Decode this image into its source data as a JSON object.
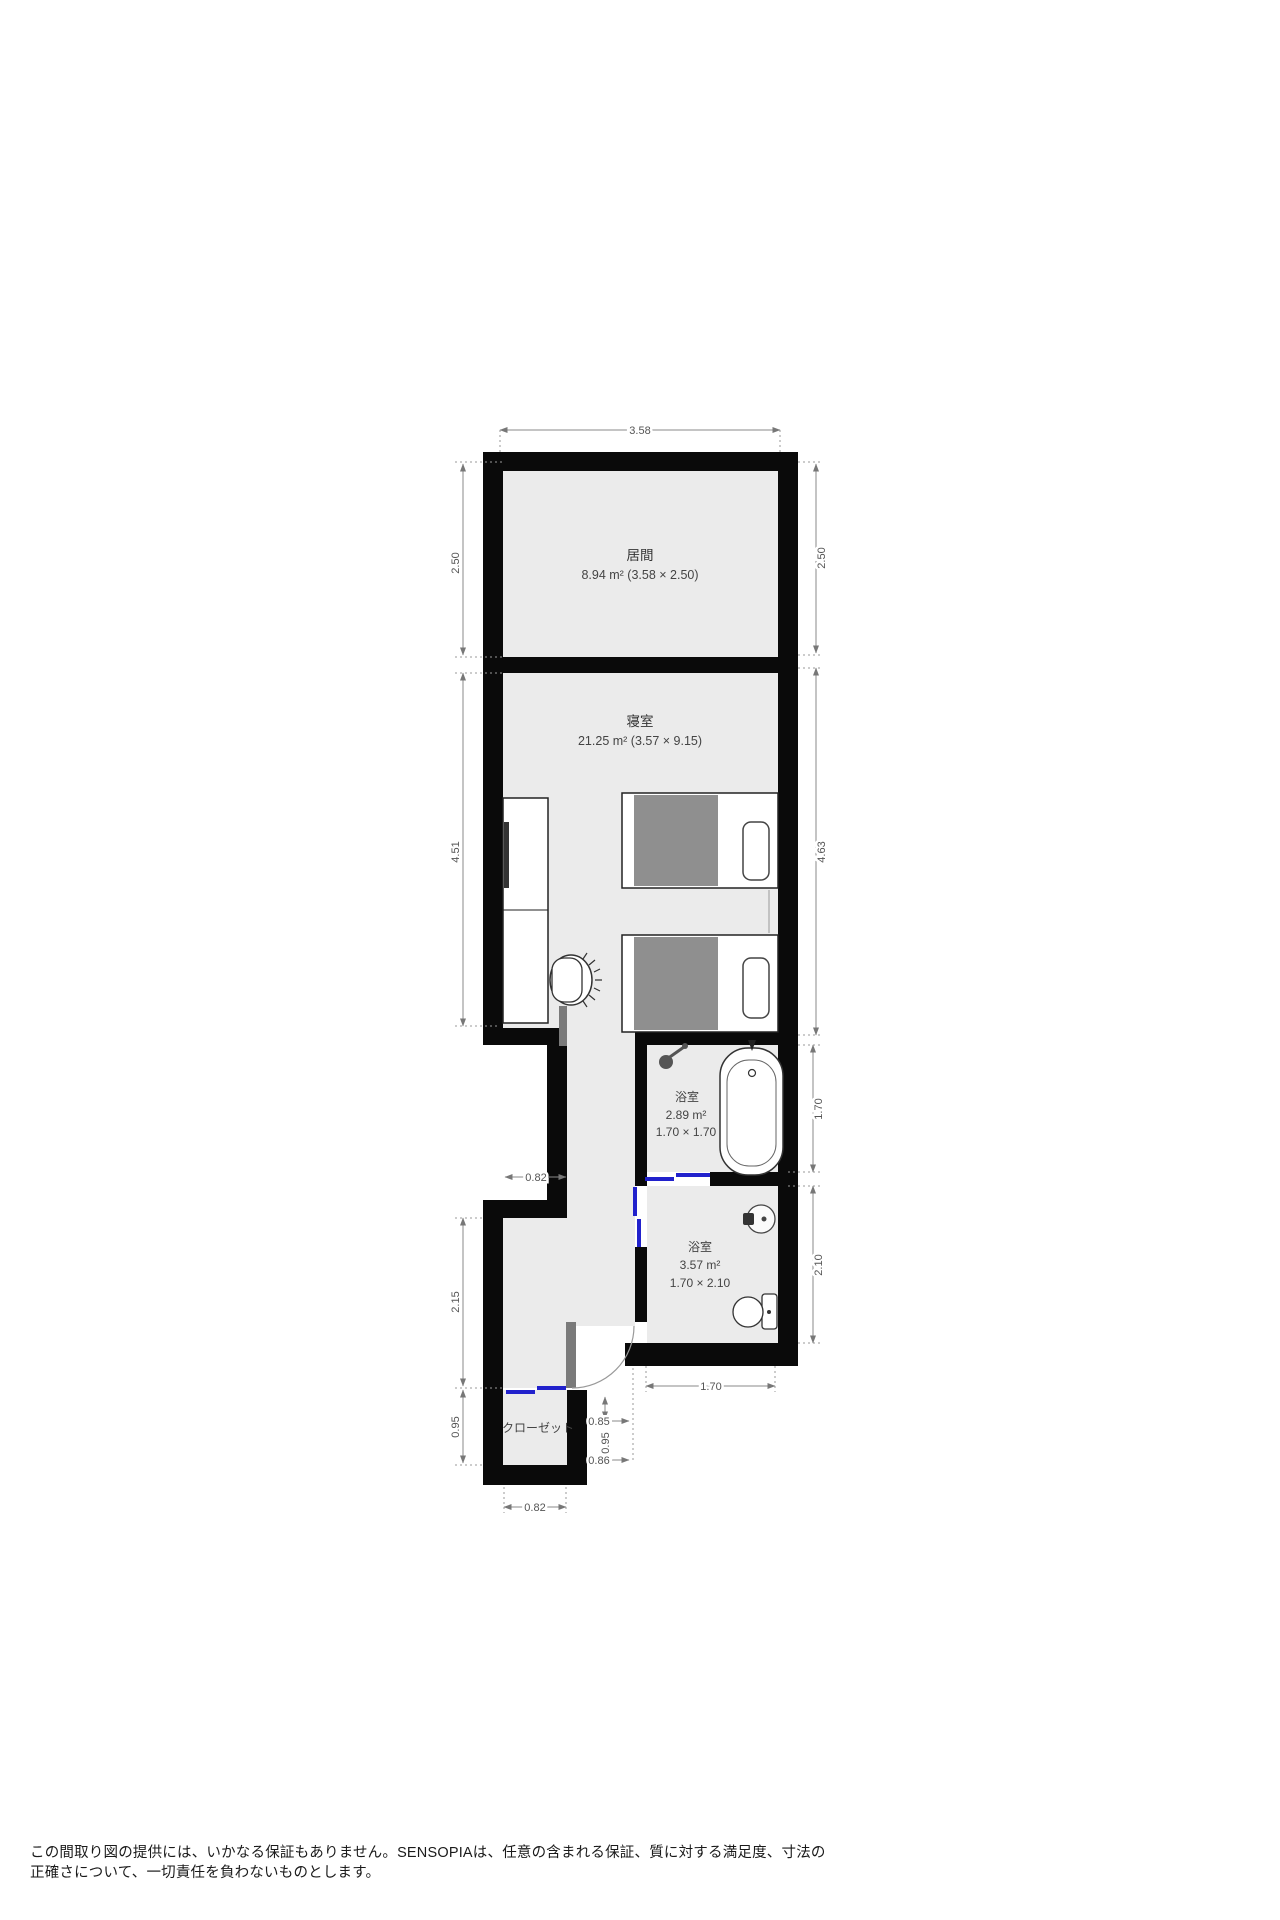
{
  "plan": {
    "colors": {
      "wall": "#0a0a0a",
      "floor": "#ebebeb",
      "door_accent": "#2121cc",
      "door_leaf": "#7a7a7a",
      "blanket": "#8f8f8f",
      "dimension": "#8a8a8a"
    },
    "rooms": {
      "living_room": {
        "name": "居間",
        "area_line": "8.94 m² (3.58 × 2.50)"
      },
      "bedroom": {
        "name": "寝室",
        "area_line": "21.25 m² (3.57 × 9.15)"
      },
      "bathroom_upper": {
        "name": "浴室",
        "area_line": "2.89 m²",
        "size_line": "1.70 × 1.70"
      },
      "bathroom_lower": {
        "name": "浴室",
        "area_line": "3.57 m²",
        "size_line": "1.70 × 2.10"
      },
      "closet": {
        "name": "クローゼット"
      }
    },
    "dims": {
      "top_width": "3.58",
      "living_left_height": "2.50",
      "living_right_height": "2.50",
      "bedroom_left_height": "4.51",
      "bedroom_right_height": "4.63",
      "bath_upper_right_height": "1.70",
      "bath_lower_right_height": "2.10",
      "bath_lower_bottom_width": "1.70",
      "notch_width": "0.82",
      "hall_left_height": "2.15",
      "closet_left_height": "0.95",
      "entry_width_a": "0.85",
      "entry_height_b": "0.95",
      "entry_width_c": "0.86",
      "closet_bottom_width": "0.82"
    }
  },
  "footer": {
    "line1": "この間取り図の提供には、いかなる保証もありません。SENSOPIAは、任意の含まれる保証、質に対する満足度、寸法の",
    "line2": "正確さについて、一切責任を負わないものとします。"
  }
}
